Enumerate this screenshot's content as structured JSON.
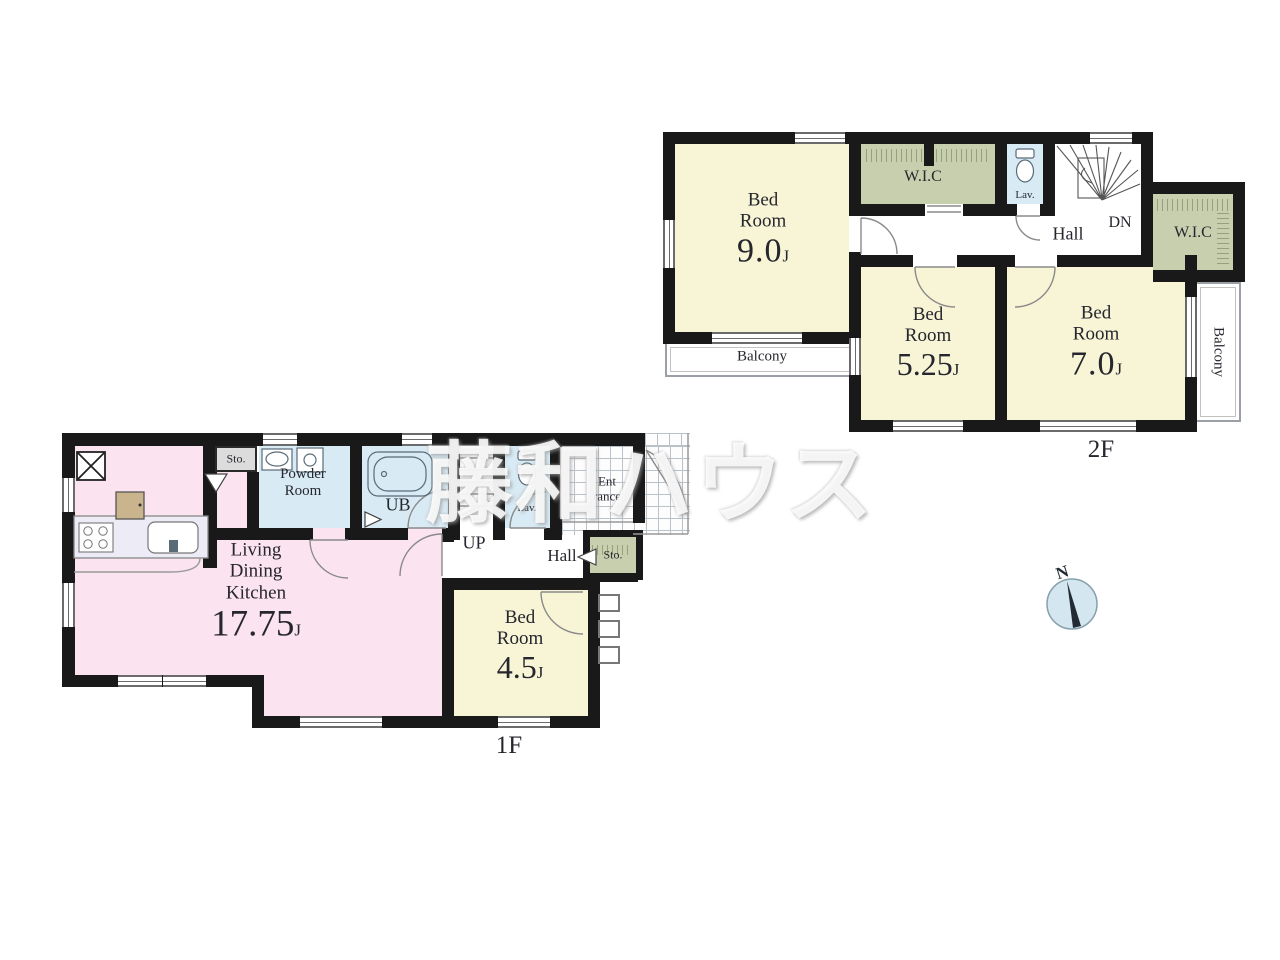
{
  "watermark_text": "藤和ハウス",
  "compass": {
    "north_label": "N"
  },
  "colors": {
    "wall": "#191919",
    "room_cream": "#f7f5d6",
    "room_pink": "#fbe3f0",
    "room_blue": "#d8eaf4",
    "closet_green": "#c8cfae",
    "storage_gray": "#dcdcdc",
    "balcony_border": "#9aa0a6",
    "watermark_color": "#ffffff",
    "compass_fill": "#d4e6ef"
  },
  "floor_2f": {
    "floor_label": "2F",
    "bedroom_9": {
      "line1": "Bed",
      "line2": "Room",
      "size": "9.0",
      "size_unit": "J"
    },
    "bedroom_525": {
      "line1": "Bed",
      "line2": "Room",
      "size": "5.25",
      "size_unit": "J"
    },
    "bedroom_7": {
      "line1": "Bed",
      "line2": "Room",
      "size": "7.0",
      "size_unit": "J"
    },
    "wic_top_label": "W.I.C",
    "wic_right_label": "W.I.C",
    "lav_label": "Lav.",
    "hall_label": "Hall",
    "down_label": "DN",
    "balcony_south_label": "Balcony",
    "balcony_east_label": "Balcony"
  },
  "floor_1f": {
    "floor_label": "1F",
    "ldk": {
      "line1": "Living",
      "line2": "Dining",
      "line3": "Kitchen",
      "size": "17.75",
      "size_unit": "J"
    },
    "bedroom_45": {
      "line1": "Bed",
      "line2": "Room",
      "size": "4.5",
      "size_unit": "J"
    },
    "powder_room": {
      "line1": "Powder",
      "line2": "Room"
    },
    "ub_label": "UB",
    "lav_label": "Lav.",
    "up_label": "UP",
    "hall_label": "Hall",
    "storage_top_label": "Sto.",
    "storage_hall_label": "Sto.",
    "entrance": {
      "line1": "Ent",
      "line2": "rance"
    }
  }
}
